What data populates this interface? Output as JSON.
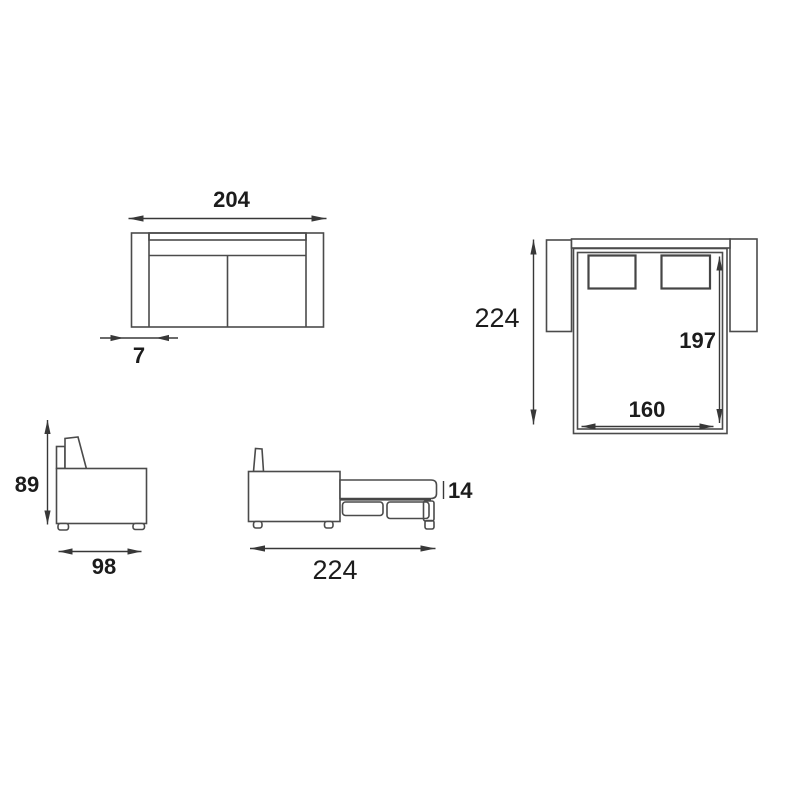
{
  "title": "sofa-bed technical dimension drawing",
  "views": {
    "front_closed": {
      "name": "front view (sofa closed)",
      "overall_width_label": "204",
      "armrest_width_label": "7"
    },
    "top_open": {
      "name": "top view (bed open)",
      "overall_depth_label": "224",
      "bed_length_label": "197",
      "bed_width_label": "160"
    },
    "side_closed": {
      "name": "side view (sofa closed)",
      "height_label": "89",
      "depth_label": "98"
    },
    "side_open": {
      "name": "side view (bed open)",
      "overall_length_label": "224",
      "mattress_thickness_label": "14"
    }
  },
  "colors": {
    "line": "#4b4b4b",
    "dimension": "#383838",
    "backrest_strip": "#e2e2e2",
    "box_gray": "#c6c6c6",
    "box_gray_2": "#bdbdbd",
    "box_gray_dark": "#9a9a9a",
    "background": "#ffffff"
  }
}
